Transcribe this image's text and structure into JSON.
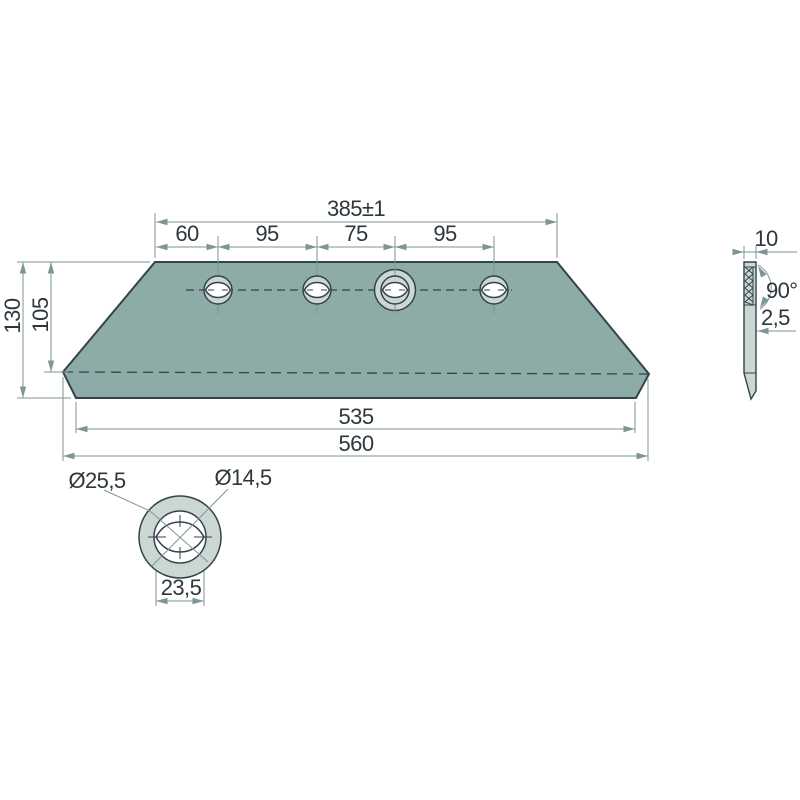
{
  "colors": {
    "plate": "#8EACA7",
    "light": "#CBD7D3",
    "outline": "#34424A",
    "dim": "#7E9596",
    "text": "#2D373C",
    "background": "#FFFFFF"
  },
  "views": {
    "front": {
      "dims": {
        "top_total": "385±1",
        "spacings": [
          "60",
          "95",
          "75",
          "95"
        ],
        "height_total": "130",
        "height_edge": "105",
        "bottom_inner": "535",
        "bottom_total": "560"
      }
    },
    "side": {
      "thickness": "10",
      "angle": "90°",
      "land": "2,5"
    },
    "detail": {
      "countersink": "Ø25,5",
      "hole": "Ø14,5",
      "slot_width": "23,5"
    }
  }
}
